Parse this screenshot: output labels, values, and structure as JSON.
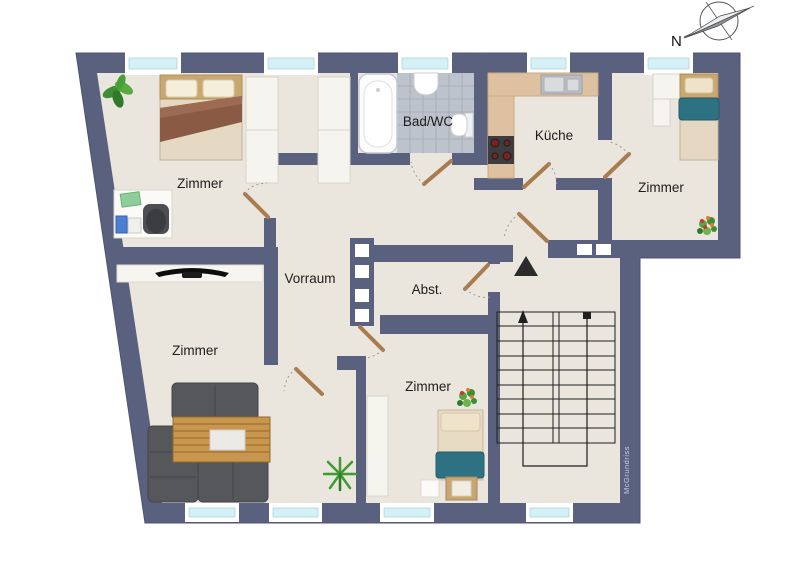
{
  "compass": {
    "label": "N"
  },
  "watermark": "McGrundriss",
  "rooms": [
    {
      "id": "zimmer-nw",
      "label": "Zimmer"
    },
    {
      "id": "bad-wc",
      "label": "Bad/WC"
    },
    {
      "id": "kueche",
      "label": "Küche"
    },
    {
      "id": "zimmer-ne",
      "label": "Zimmer"
    },
    {
      "id": "vorraum",
      "label": "Vorraum"
    },
    {
      "id": "abstellraum",
      "label": "Abst."
    },
    {
      "id": "zimmer-sw",
      "label": "Zimmer"
    },
    {
      "id": "zimmer-s",
      "label": "Zimmer"
    }
  ],
  "colors": {
    "wall": "#59617e",
    "floor": "#eae6dd",
    "window_glass": "#d5f1f8",
    "bath_tile": "#bdc3cc",
    "kitchen_counter": "#ddc1a0",
    "door_wood": "#a87c4e",
    "bed_blanket_brown": "#8a5a44",
    "bed_blanket_teal": "#2e7183",
    "sofa_gray": "#55575b",
    "table_wood": "#c8964d"
  }
}
